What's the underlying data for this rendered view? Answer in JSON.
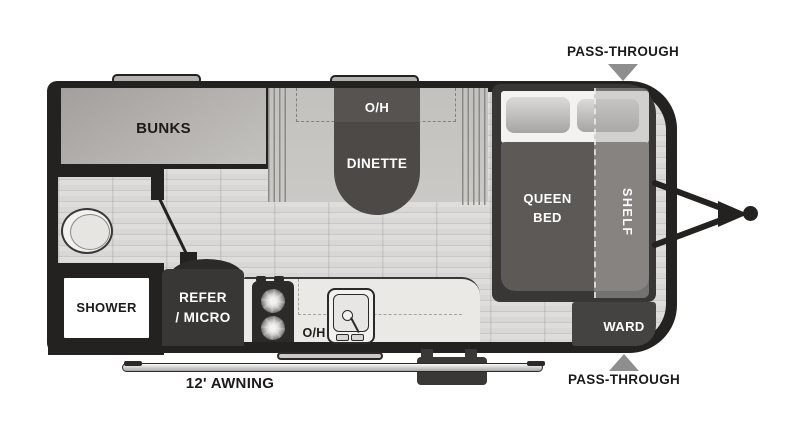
{
  "floorplan": {
    "rooms": {
      "bunks": "BUNKS",
      "dinette_overhead": "O/H",
      "dinette": "DINETTE",
      "queen_bed": "QUEEN\nBED",
      "shelf": "SHELF",
      "ward": "WARD",
      "shower": "SHOWER",
      "refer_micro": "REFER\n/ MICRO",
      "kitchen_overhead": "O/H"
    },
    "callouts": {
      "pass_through_top": "PASS-THROUGH",
      "pass_through_bottom": "PASS-THROUGH",
      "awning": "12' AWNING"
    },
    "icons": [
      "toilet-icon",
      "sink-icon",
      "stove-burner-icon",
      "wheel-arc-icon",
      "roof-vent-icon",
      "entry-step-icon",
      "awning-rail-icon",
      "hitch-icon",
      "pass-through-arrow-icon"
    ],
    "colors": {
      "wall": "#242221",
      "floor": "#d8d7d5",
      "furniture_dark": "#4c4947",
      "bed_platform": "#393736",
      "mattress": "#5c5956",
      "bench": "#c8c6c3",
      "counter": "#eae9e6",
      "ward": "#454342",
      "callout_arrow": "#8e8e8e",
      "text_dark": "#1d1b1a",
      "text_light": "#ffffff"
    }
  }
}
